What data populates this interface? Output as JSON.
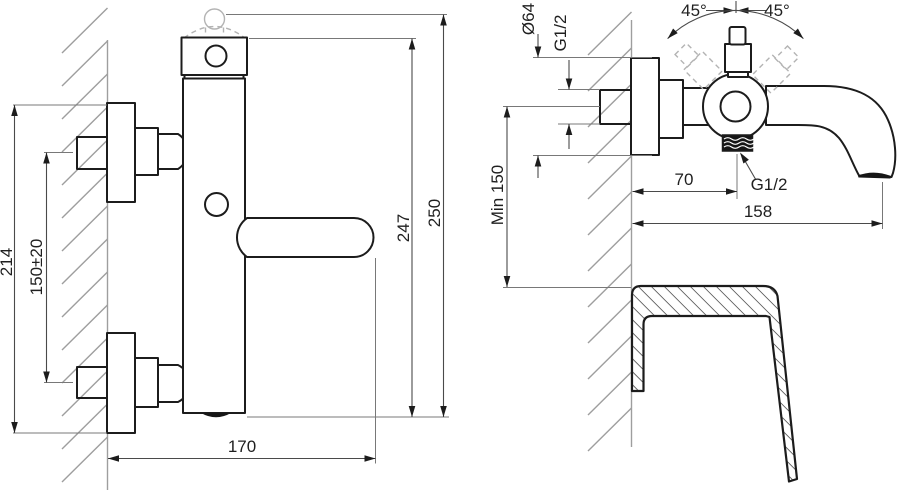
{
  "front_view": {
    "mount_span": "214",
    "inlet_spacing": "150±20",
    "body_height": "247",
    "total_height": "250",
    "width_to_handle_tip": "170"
  },
  "side_view": {
    "escutcheon_diameter": "Ø64",
    "inlet_thread": "G1/2",
    "handle_angle_left": "45°",
    "handle_angle_right": "45°",
    "min_height_above_rim": "Min 150",
    "shower_outlet_offset": "70",
    "shower_outlet_thread": "G1/2",
    "spout_reach": "158"
  },
  "colors": {
    "outline": "#1c1c1c",
    "dimension": "#4a4a4a",
    "extension": "#787878",
    "wall": "#9e9e9e",
    "ghost": "#b3b3b3",
    "background": "#ffffff"
  }
}
